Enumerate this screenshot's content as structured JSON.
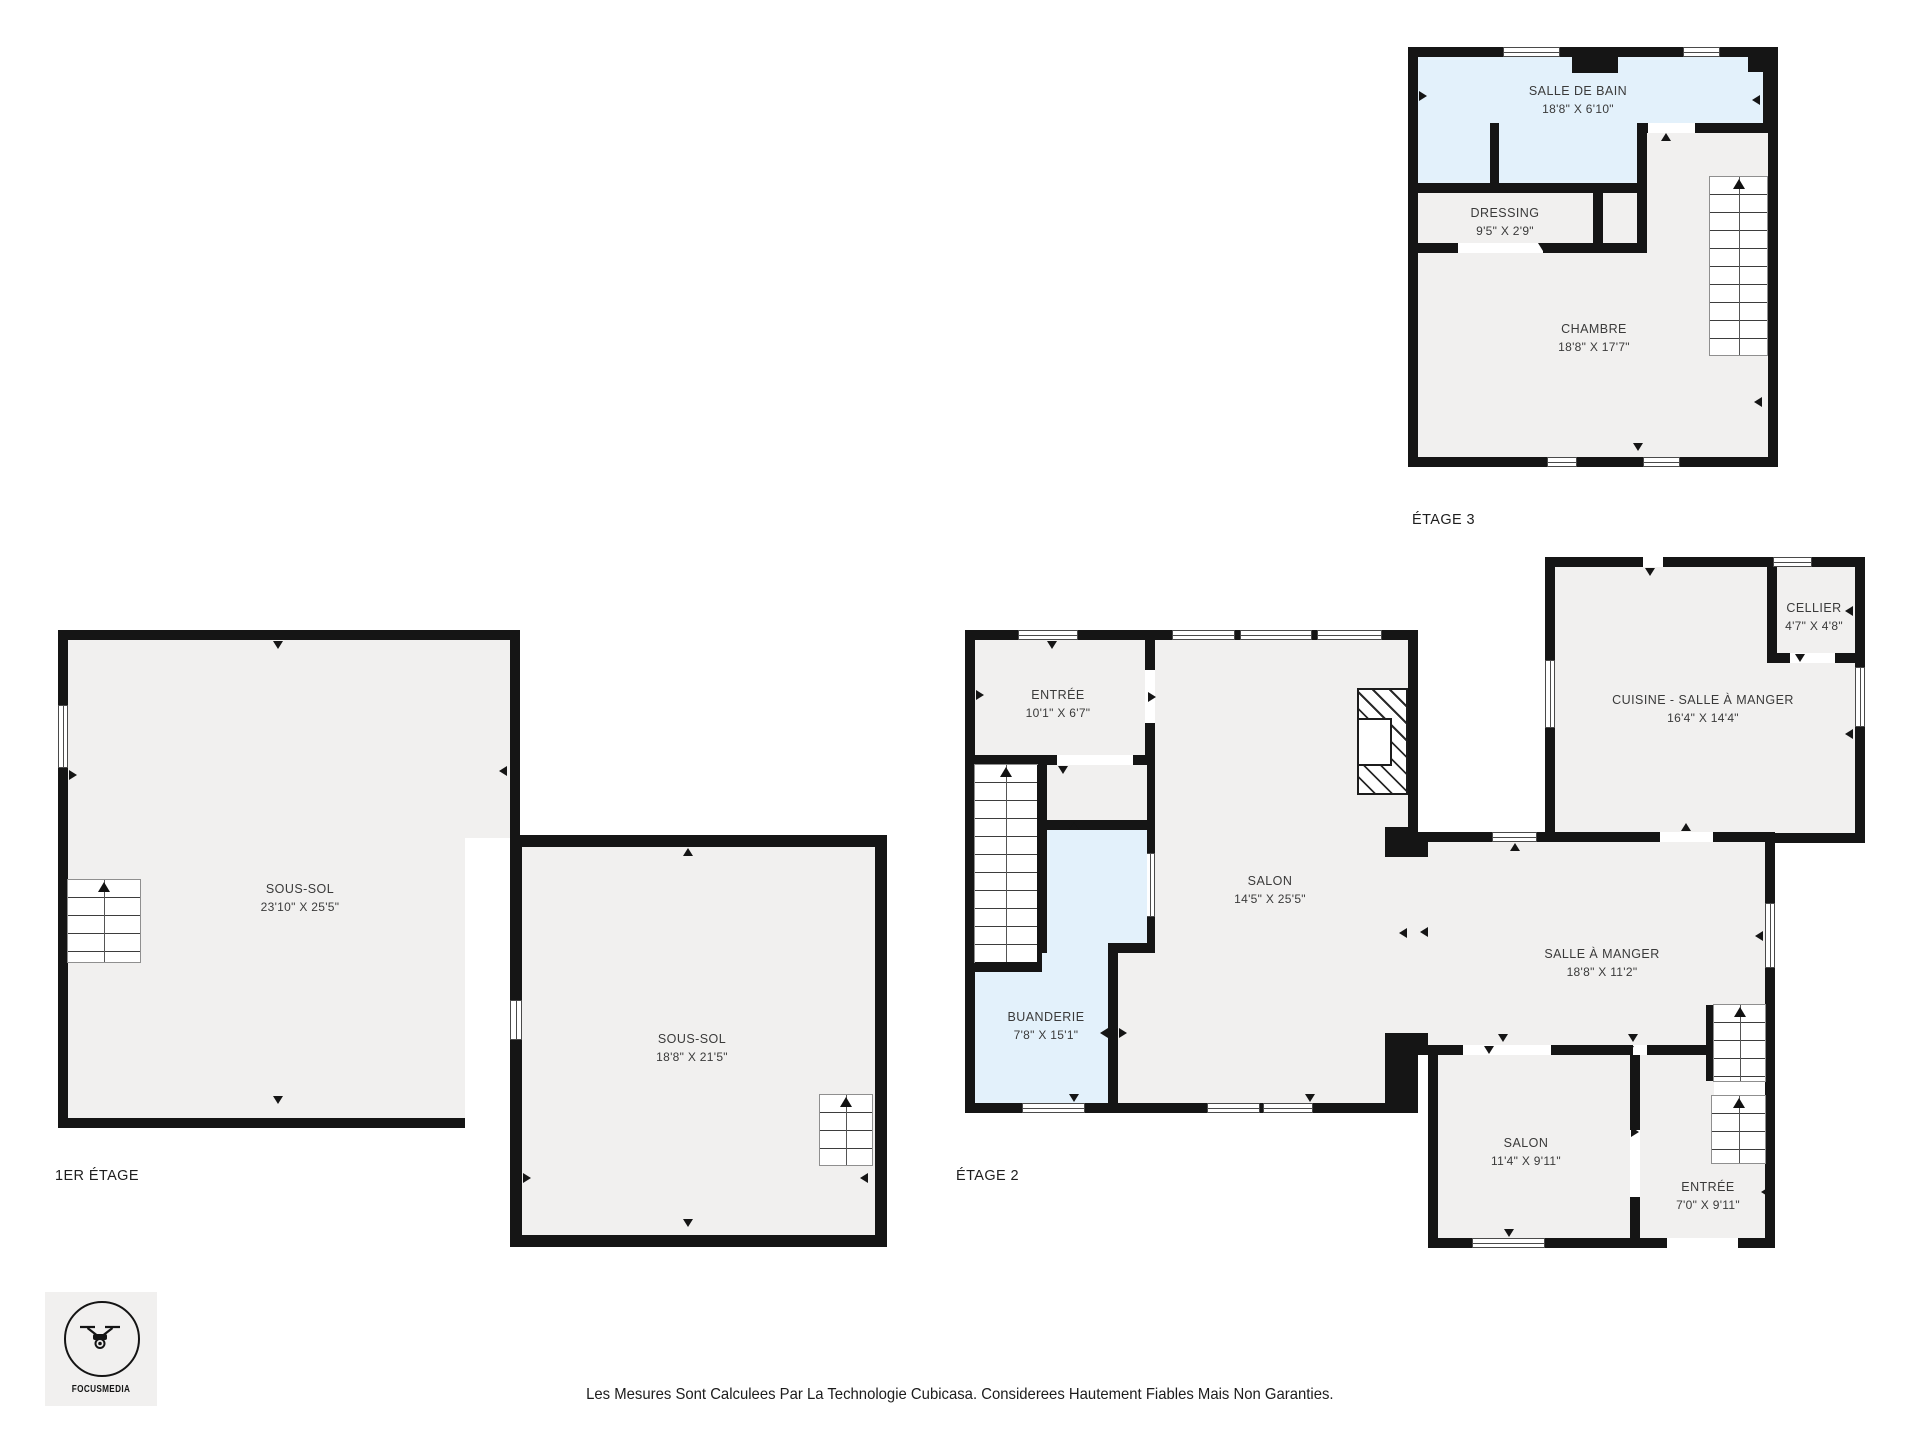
{
  "colors": {
    "wall": "#151515",
    "floor_fill": "#f1f0ef",
    "wet_room_fill": "#e3f1fb",
    "label_text": "#3a3a3a"
  },
  "floors": [
    {
      "label": "ÉTAGE 3",
      "rooms": [
        {
          "name": "SALLE DE BAIN",
          "dims": "18'8\" X 6'10\""
        },
        {
          "name": "DRESSING",
          "dims": "9'5\" X 2'9\""
        },
        {
          "name": "CHAMBRE",
          "dims": "18'8\" X 17'7\""
        }
      ]
    },
    {
      "label": "1ER ÉTAGE",
      "rooms": [
        {
          "name": "SOUS-SOL",
          "dims": "23'10\" X 25'5\""
        },
        {
          "name": "SOUS-SOL",
          "dims": "18'8\" X 21'5\""
        }
      ]
    },
    {
      "label": "ÉTAGE 2",
      "rooms": [
        {
          "name": "ENTRÉE",
          "dims": "10'1\" X 6'7\""
        },
        {
          "name": "SALON",
          "dims": "14'5\" X 25'5\""
        },
        {
          "name": "BUANDERIE",
          "dims": "7'8\" X 15'1\""
        },
        {
          "name": "CUISINE - SALLE À MANGER",
          "dims": "16'4\" X 14'4\""
        },
        {
          "name": "CELLIER",
          "dims": "4'7\" X 4'8\""
        },
        {
          "name": "SALLE À MANGER",
          "dims": "18'8\" X 11'2\""
        },
        {
          "name": "SALON",
          "dims": "11'4\" X 9'11\""
        },
        {
          "name": "ENTRÉE",
          "dims": "7'0\" X 9'11\""
        }
      ]
    }
  ],
  "logo": {
    "brand": "FOCUSMEDIA"
  },
  "footer": {
    "disclaimer": "Les Mesures Sont Calculees Par La Technologie Cubicasa. Considerees Hautement Fiables Mais Non Garanties."
  }
}
